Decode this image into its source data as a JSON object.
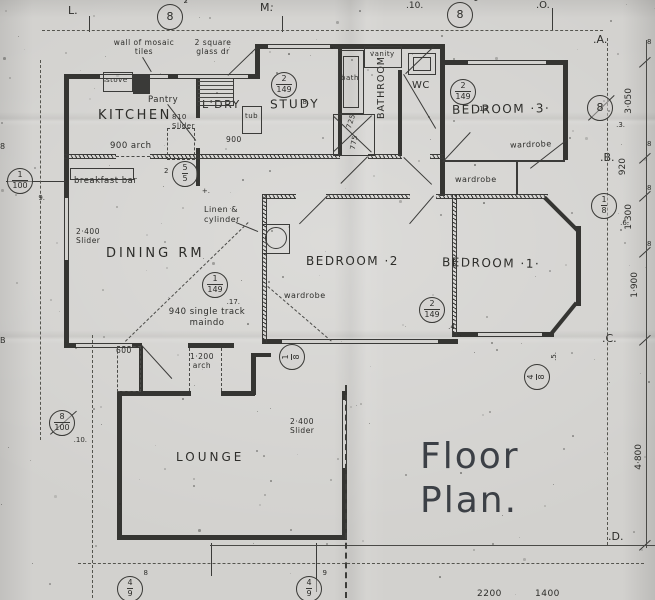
{
  "title": {
    "line1": "Floor",
    "line2": "Plan."
  },
  "rooms": {
    "kitchen": "KITCHEN",
    "pantry": "Pantry",
    "laundry": "L'DRY",
    "study": "STUDY",
    "bathroom": "BATHROOM",
    "wc": "WC",
    "bedroom3": "BEDROOM ·3·",
    "dining": "DINING RM",
    "bedroom2": "BEDROOM ·2",
    "bedroom1": "BEDROOM ·1·",
    "lounge": "LOUNGE"
  },
  "labels": {
    "mosaic": "wall of mosaic\ntiles",
    "glass_door": "2 square\nglass dr",
    "stove": "stove",
    "arch900": "900 arch",
    "dim900": "900",
    "slider810": "810\nSlider",
    "tub": "tub",
    "bath": "bath",
    "vanity": "vanity",
    "dim725": "725",
    "dim775": "775",
    "breakfast_bar": "breakfast bar",
    "slider2400_a": "2·400\nSlider",
    "linen": "Linen &\ncylinder",
    "track940": "940 single track\nmaindo",
    "wardrobe": "wardrobe",
    "dim600": "600",
    "arch1200": "1·200\narch",
    "slider2400_b": "2·400\nSlider"
  },
  "grid": {
    "L": "L.",
    "M": "M.",
    "n10": ".10.",
    "O": ".O.",
    "A": ".A.",
    "B": ".B.",
    "C": ".C.",
    "D": ".D."
  },
  "dims": {
    "right": [
      "3·050",
      "920",
      "1·300",
      "1·900",
      "4·800"
    ],
    "bottom": [
      "2200",
      "1400"
    ],
    "edge": [
      "8",
      "8",
      "8",
      "8"
    ],
    "left_edge": [
      "8",
      "B"
    ]
  },
  "markers": [
    {
      "top": "8",
      "sup": "2"
    },
    {
      "top": "8",
      "sup": "1"
    },
    {
      "top": "2",
      "bottom": "149",
      "side": ".8."
    },
    {
      "top": "5",
      "bottom": "5",
      "side": "+.",
      "pre": "2"
    },
    {
      "top": "2",
      "bottom": "149",
      "side": ".13"
    },
    {
      "top": "8",
      "side": ".3."
    },
    {
      "top": "1",
      "bottom": "8",
      "side": ".6."
    },
    {
      "top": "1",
      "bottom": "149",
      "side": ".17."
    },
    {
      "top": "2",
      "bottom": "149",
      "side": ".4."
    },
    {
      "top": "1",
      "bottom": "8",
      "side": ""
    },
    {
      "top": "8",
      "bottom": "100",
      "side": ".10."
    },
    {
      "top": "1",
      "bottom": "100",
      "side": "9."
    },
    {
      "top": "4",
      "bottom": "8",
      "side": ".5."
    },
    {
      "top": "4",
      "bottom": "9",
      "sup": "8"
    },
    {
      "top": "4",
      "bottom": "9",
      "sup": "9"
    }
  ]
}
